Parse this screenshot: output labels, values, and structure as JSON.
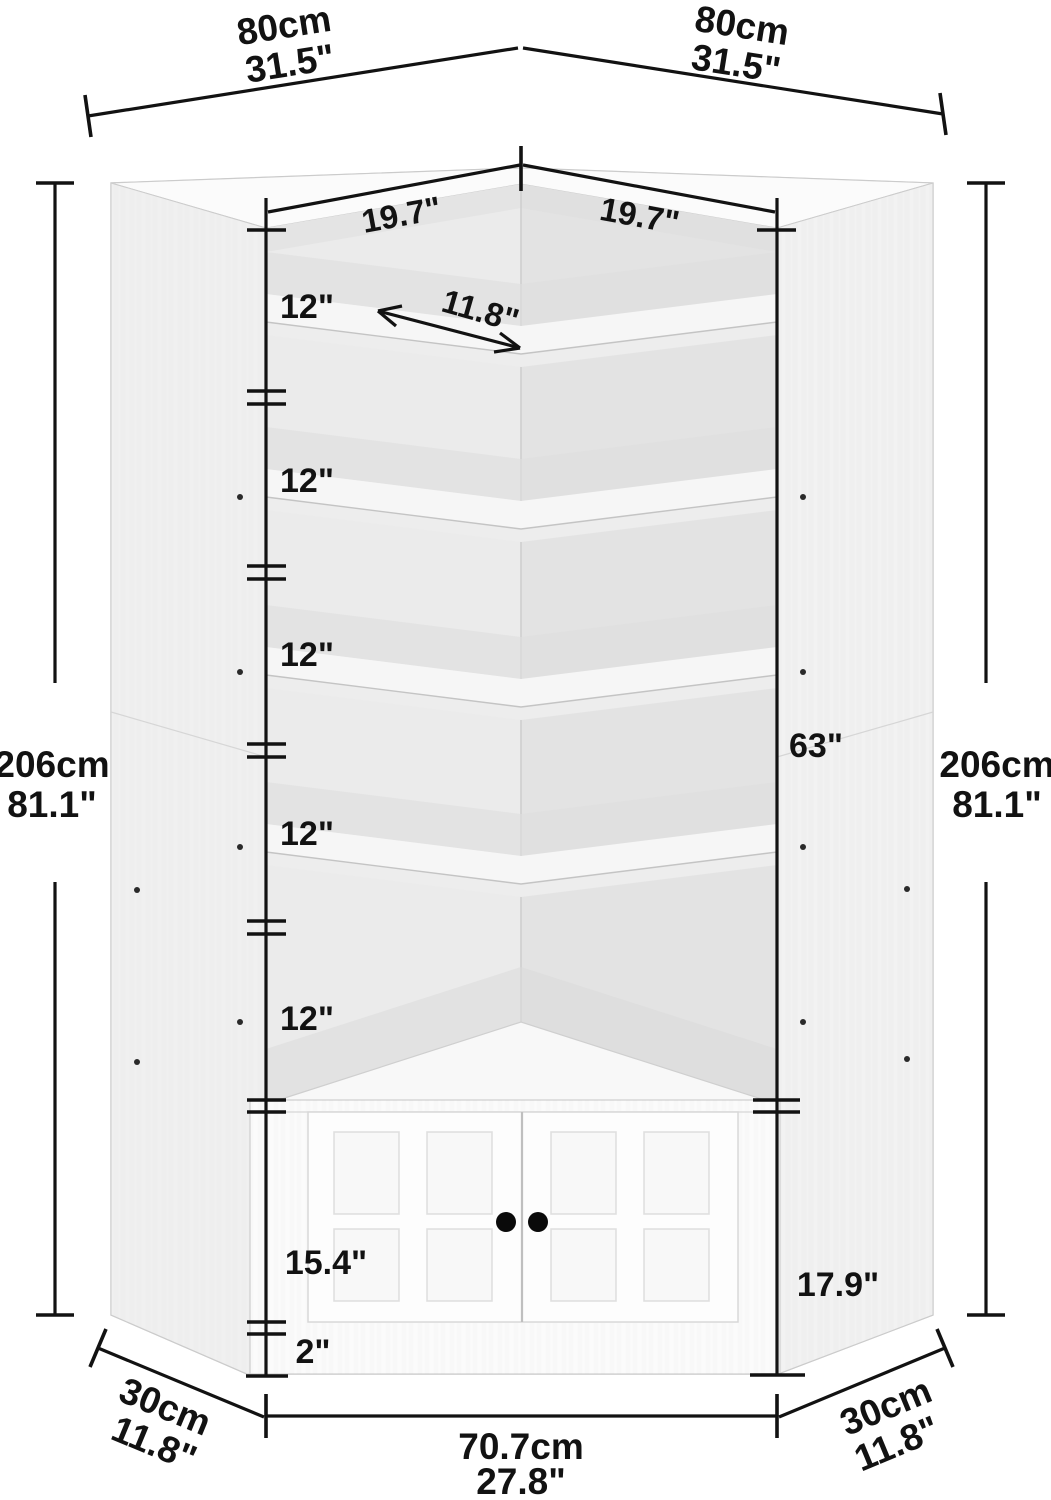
{
  "dimensions": {
    "top_width_left_cm": "80cm",
    "top_width_left_in": "31.5\"",
    "top_width_right_cm": "80cm",
    "top_width_right_in": "31.5\"",
    "height_left_cm": "206cm",
    "height_left_in": "81.1\"",
    "height_right_cm": "206cm",
    "height_right_in": "81.1\"",
    "shelf_width_left": "19.7\"",
    "shelf_width_right": "19.7\"",
    "shelf_depth": "11.8\"",
    "compartments": [
      "12\"",
      "12\"",
      "12\"",
      "12\"",
      "12\""
    ],
    "open_shelf_height": "63\"",
    "door_height": "15.4\"",
    "cabinet_section_height": "17.9\"",
    "base_height": "2\"",
    "front_width_cm": "70.7cm",
    "front_width_in": "27.8\"",
    "side_depth_left_cm": "30cm",
    "side_depth_left_in": "11.8\"",
    "side_depth_right_cm": "30cm",
    "side_depth_right_in": "11.8\""
  },
  "colors": {
    "dimension_line": "#121212",
    "knob": "#0a0a0a",
    "panel": "#f4f4f4"
  }
}
